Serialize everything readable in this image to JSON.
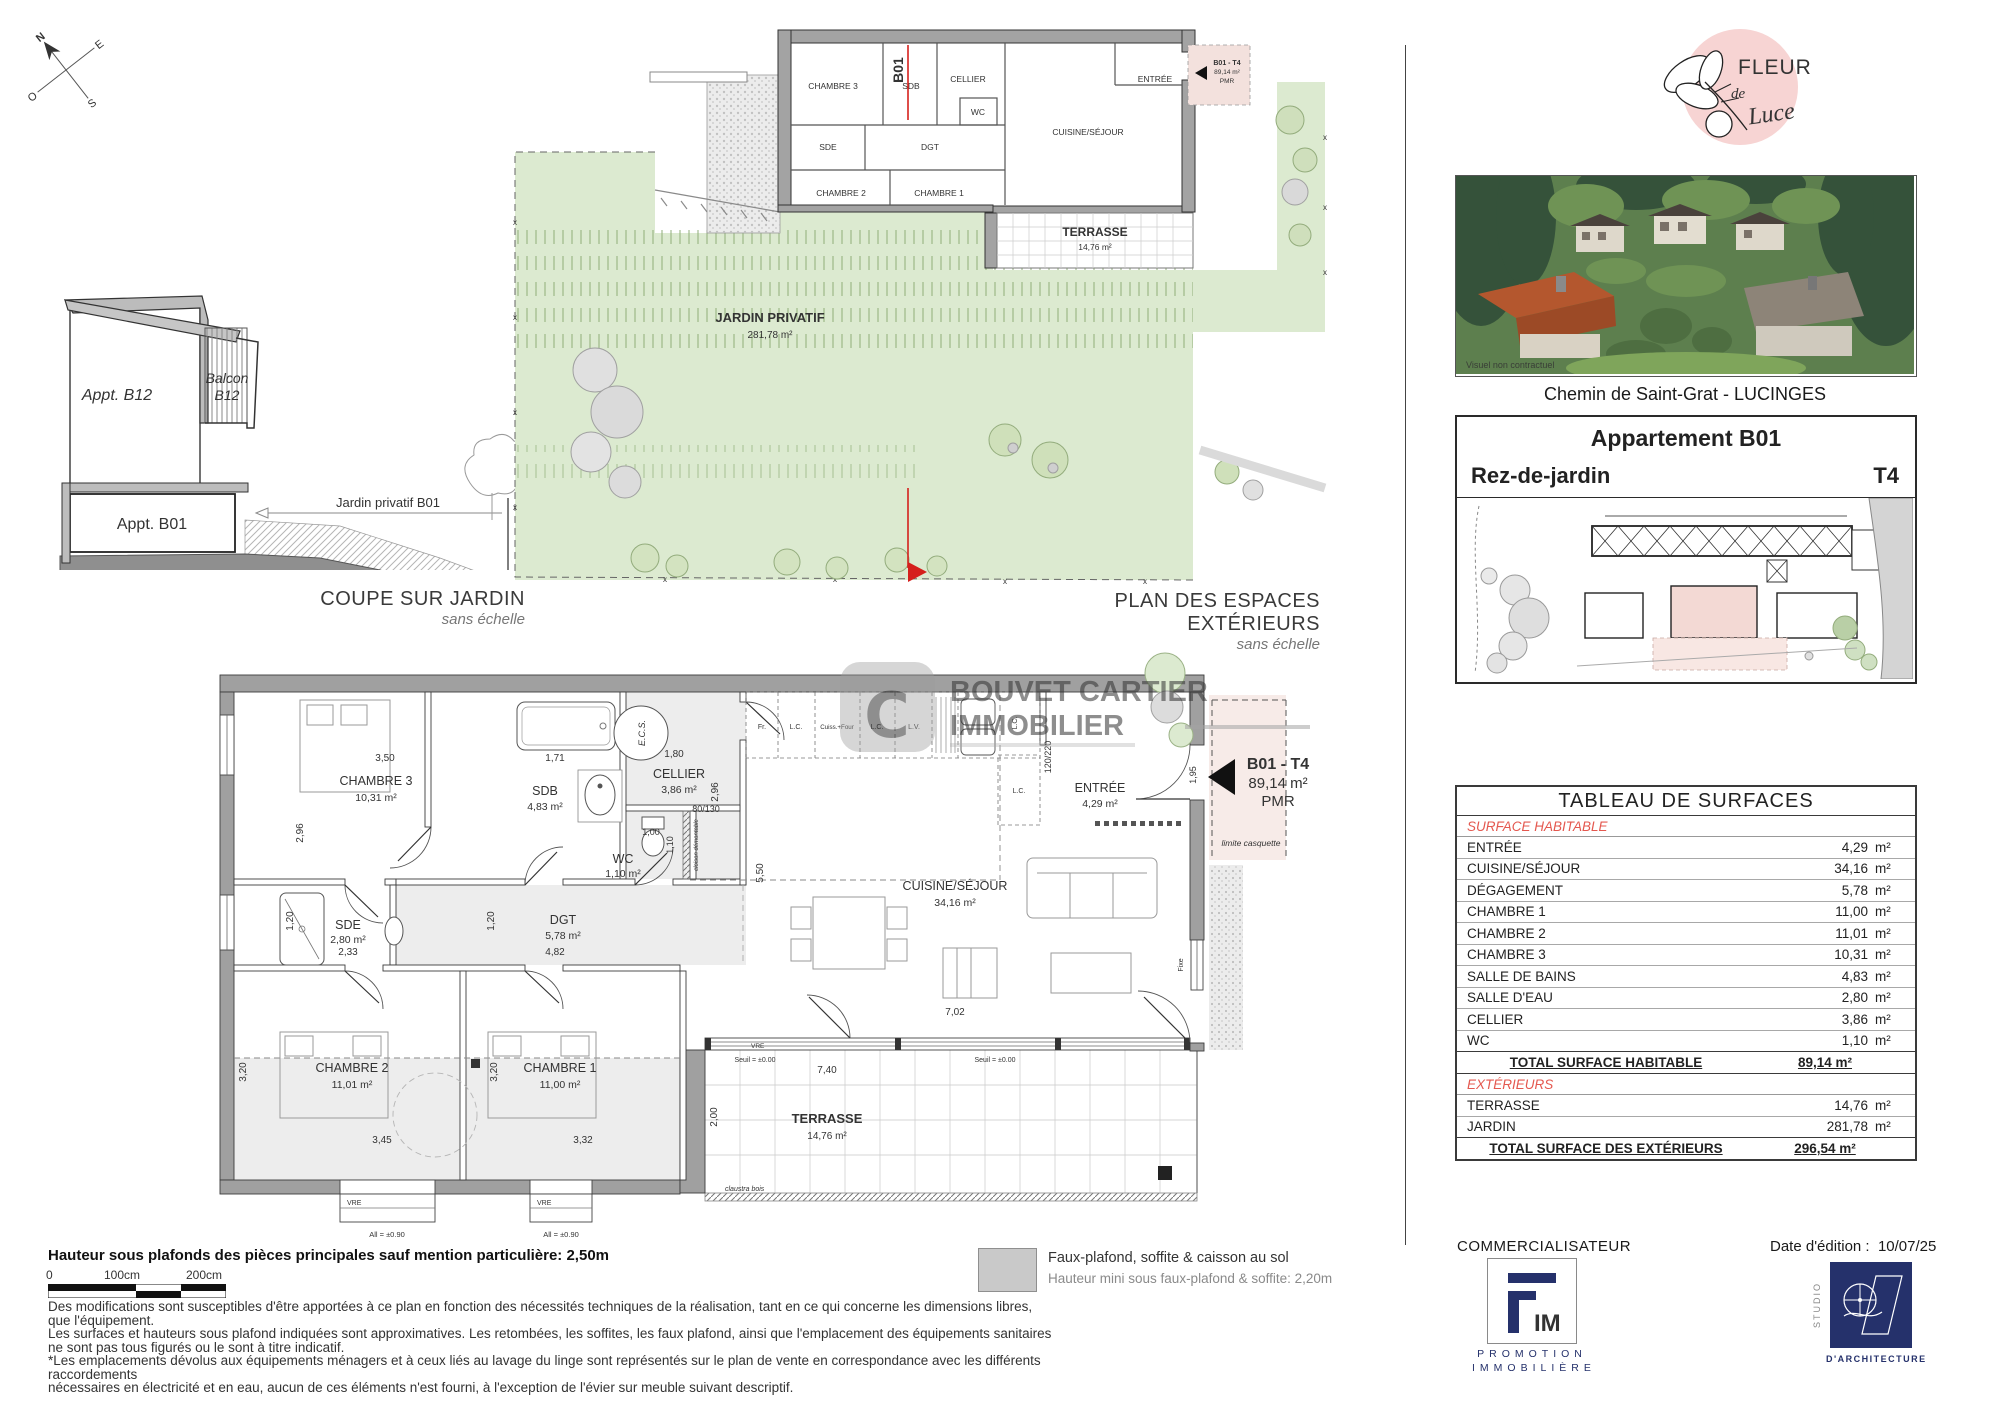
{
  "colors": {
    "accent_red": "#d5201c",
    "table_red": "#e4584f",
    "brand_pink": "#f7d4d3",
    "logo_red": "#c4404f",
    "navy": "#25316b",
    "garden_green": "#dcead0",
    "wall_gray": "#a0a0a0",
    "watermark_yellow": "#dfae49"
  },
  "compass": {
    "n": "N",
    "e": "E",
    "s": "S",
    "o": "O"
  },
  "coupe": {
    "title": "COUPE SUR JARDIN",
    "subtitle": "sans échelle",
    "appt_b12": "Appt. B12",
    "balcon_line1": "Balcon",
    "balcon_line2": "B12",
    "appt_b01": "Appt. B01",
    "jardin": "Jardin privatif B01"
  },
  "exterior_plan": {
    "title": "PLAN DES ESPACES EXTÉRIEURS",
    "subtitle": "sans échelle",
    "jardin": "JARDIN PRIVATIF",
    "jardin_area": "281,78 m²",
    "terrasse": "TERRASSE",
    "terrasse_area": "14,76 m²",
    "b01": "B01",
    "tag_code": "B01 - T4",
    "tag_area": "89,14 m²",
    "tag_pmr": "PMR",
    "rooms": {
      "chambre3": "CHAMBRE 3",
      "sdb": "SDB",
      "cellier": "CELLIER",
      "wc": "WC",
      "sde": "SDE",
      "dgt": "DGT",
      "chambre2": "CHAMBRE 2",
      "chambre1": "CHAMBRE 1",
      "entree": "ENTRÉE",
      "cuisine": "CUISINE/SÉJOUR"
    }
  },
  "main_plan": {
    "rooms": {
      "chambre3": {
        "name": "CHAMBRE 3",
        "area": "10,31 m²"
      },
      "sdb": {
        "name": "SDB",
        "area": "4,83 m²"
      },
      "cellier": {
        "name": "CELLIER",
        "area": "3,86 m²"
      },
      "wc": {
        "name": "WC",
        "area": "1,10 m²"
      },
      "sde": {
        "name": "SDE",
        "area": "2,80 m²"
      },
      "dgt": {
        "name": "DGT",
        "area": "5,78 m²"
      },
      "chambre2": {
        "name": "CHAMBRE 2",
        "area": "11,01 m²"
      },
      "chambre1": {
        "name": "CHAMBRE 1",
        "area": "11,00 m²"
      },
      "cuisine": {
        "name": "CUISINE/SÉJOUR",
        "area": "34,16 m²"
      },
      "entree": {
        "name": "ENTRÉE",
        "area": "4,29 m²"
      },
      "terrasse": {
        "name": "TERRASSE",
        "area": "14,76 m²"
      }
    },
    "kitchen": {
      "fr": "Fr.",
      "lc1": "L.C.",
      "cuiss": "Cuiss.+Four",
      "lc2": "L.C.",
      "lv": "L.V.",
      "lc3": "L.C.",
      "lc4": "L.C.",
      "ecs": "E.C.S."
    },
    "dims": {
      "d350": "3,50",
      "d296a": "2,96",
      "d171": "1,71",
      "d180": "1,80",
      "d296b": "2,96",
      "d100": "1,00",
      "d110": "1,10",
      "d80130": "80/130",
      "d233": "2,33",
      "d120a": "1,20",
      "d482": "4,82",
      "d120b": "1,20",
      "d345": "3,45",
      "d332": "3,32",
      "d320a": "3,20",
      "d320b": "3,20",
      "d550": "5,50",
      "d702": "7,02",
      "d740": "7,40",
      "d200": "2,00",
      "d195": "1,95",
      "d120220": "120/220"
    },
    "notes": {
      "cloison": "cloison démontable",
      "vre1": "VRE",
      "vre2": "VRE",
      "vre3": "VRE",
      "fixe": "Fixe",
      "all1": "All = ±0.90",
      "all2": "All = ±0.90",
      "seuil1": "Seuil = ±0.00",
      "seuil2": "Seuil = ±0.00",
      "claustra": "claustra bois",
      "limite": "limite casquette"
    },
    "tag": {
      "code": "B01 - T4",
      "area": "89,14 m²",
      "pmr": "PMR"
    }
  },
  "watermark": {
    "line1": "BOUVET CARTIER",
    "line2": "IMMOBILIER",
    "c": "C"
  },
  "brand": {
    "fleur": "FLEUR",
    "de": "de",
    "luce": "Luce"
  },
  "photo": {
    "caption": "Chemin de Saint-Grat - LUCINGES",
    "note": "Visuel non contractuel"
  },
  "unit_header": {
    "title": "Appartement B01",
    "floor": "Rez-de-jardin",
    "type": "T4"
  },
  "surface_table": {
    "title": "TABLEAU DE SURFACES",
    "section1": "SURFACE HABITABLE",
    "rows": [
      {
        "label": "ENTRÉE",
        "value": "4,29",
        "unit": "m²"
      },
      {
        "label": "CUISINE/SÉJOUR",
        "value": "34,16",
        "unit": "m²"
      },
      {
        "label": "DÉGAGEMENT",
        "value": "5,78",
        "unit": "m²"
      },
      {
        "label": "CHAMBRE 1",
        "value": "11,00",
        "unit": "m²"
      },
      {
        "label": "CHAMBRE 2",
        "value": "11,01",
        "unit": "m²"
      },
      {
        "label": "CHAMBRE 3",
        "value": "10,31",
        "unit": "m²"
      },
      {
        "label": "SALLE DE BAINS",
        "value": "4,83",
        "unit": "m²"
      },
      {
        "label": "SALLE D'EAU",
        "value": "2,80",
        "unit": "m²"
      },
      {
        "label": "CELLIER",
        "value": "3,86",
        "unit": "m²"
      },
      {
        "label": "WC",
        "value": "1,10",
        "unit": "m²"
      }
    ],
    "total1": {
      "label": "TOTAL SURFACE HABITABLE",
      "value": "89,14 m²"
    },
    "section2": "EXTÉRIEURS",
    "rows2": [
      {
        "label": "TERRASSE",
        "value": "14,76",
        "unit": "m²"
      },
      {
        "label": "JARDIN",
        "value": "281,78",
        "unit": "m²"
      }
    ],
    "total2": {
      "label": "TOTAL SURFACE DES EXTÉRIEURS",
      "value": "296,54 m²"
    }
  },
  "footer": {
    "height_note": "Hauteur sous plafonds des pièces principales sauf mention particulière: 2,50m",
    "scale": {
      "s0": "0",
      "s100": "100cm",
      "s200": "200cm"
    },
    "legend": {
      "line1": "Faux-plafond, soffite & caisson au sol",
      "line2": "Hauteur mini sous faux-plafond & soffite: 2,20m"
    },
    "disclaimer": [
      "Des modifications sont susceptibles d'être apportées à ce plan en fonction des nécessités techniques de la réalisation, tant en ce qui concerne les dimensions libres, que l'équipement.",
      "Les surfaces et hauteurs sous plafond indiquées sont approximatives. Les retombées, les soffites, les faux plafond, ainsi que l'emplacement des équipements sanitaires ne sont pas tous figurés ou le sont à titre indicatif.",
      "*Les emplacements dévolus aux équipements ménagers et à ceux liés au lavage du linge sont représentés sur le plan de vente en correspondance avec les différents raccordements",
      "nécessaires en électricité et en eau, aucun de ces éléments n'est fourni, à l'exception de l'évier sur meuble suivant descriptif."
    ]
  },
  "commercial": {
    "label": "COMMERCIALISATEUR",
    "edition_label": "Date d'édition :",
    "edition_date": "10/07/25"
  },
  "logos": {
    "fim_im": "IM",
    "promotion": "PROMOTION",
    "immobiliere": "IMMOBILIÈRE",
    "studio_vertical": "STUDIO",
    "studio_caption": "D'ARCHITECTURE"
  }
}
